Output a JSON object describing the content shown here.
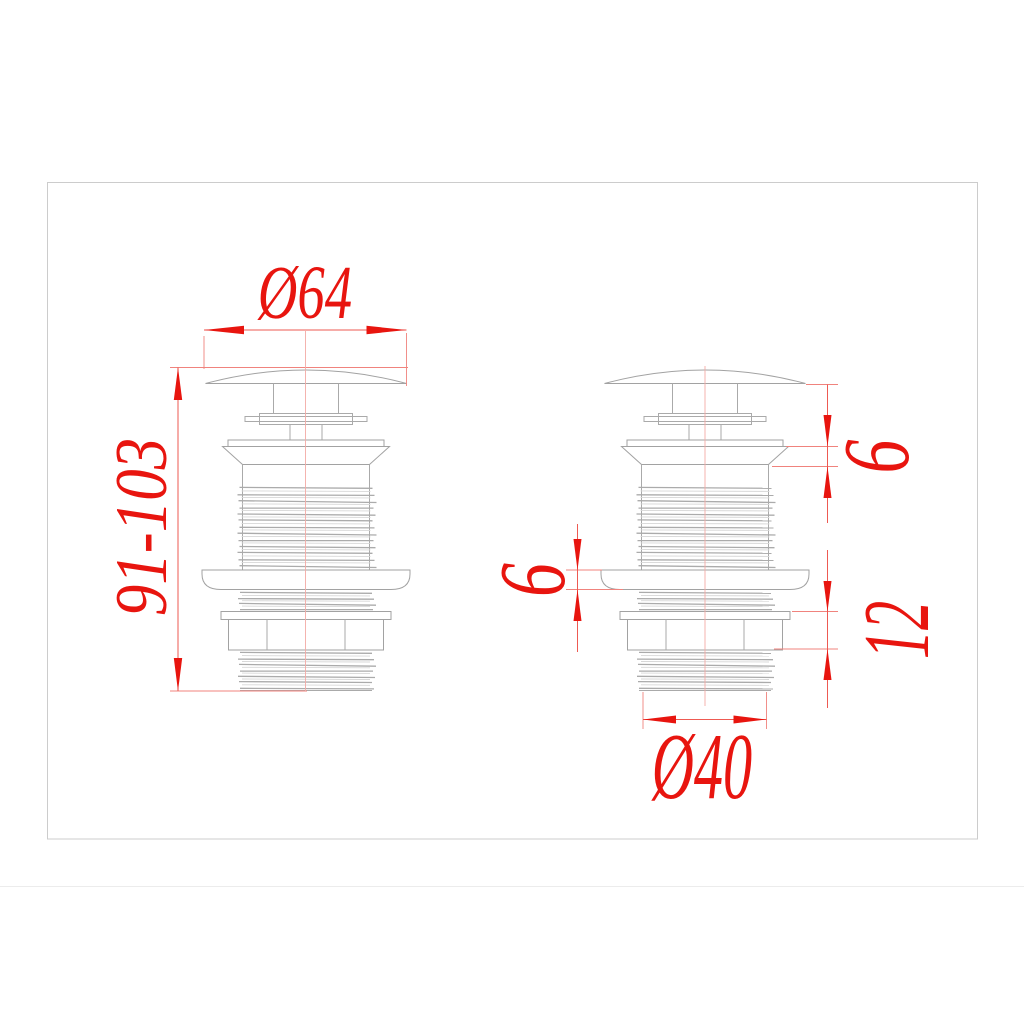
{
  "page": {
    "background": "#ffffff"
  },
  "frame": {
    "border_color": "#cccccc"
  },
  "drawing": {
    "outline_color": "#aaaaaa",
    "dimension_color": "#e8150f",
    "left_figure": {
      "cap_diameter_label": "Ø64",
      "height_range_label": "91-103"
    },
    "right_figure": {
      "flange_height_label": "6",
      "washer_thickness_label": "6",
      "locknut_section_label": "12",
      "tail_diameter_label": "Ø40"
    }
  }
}
